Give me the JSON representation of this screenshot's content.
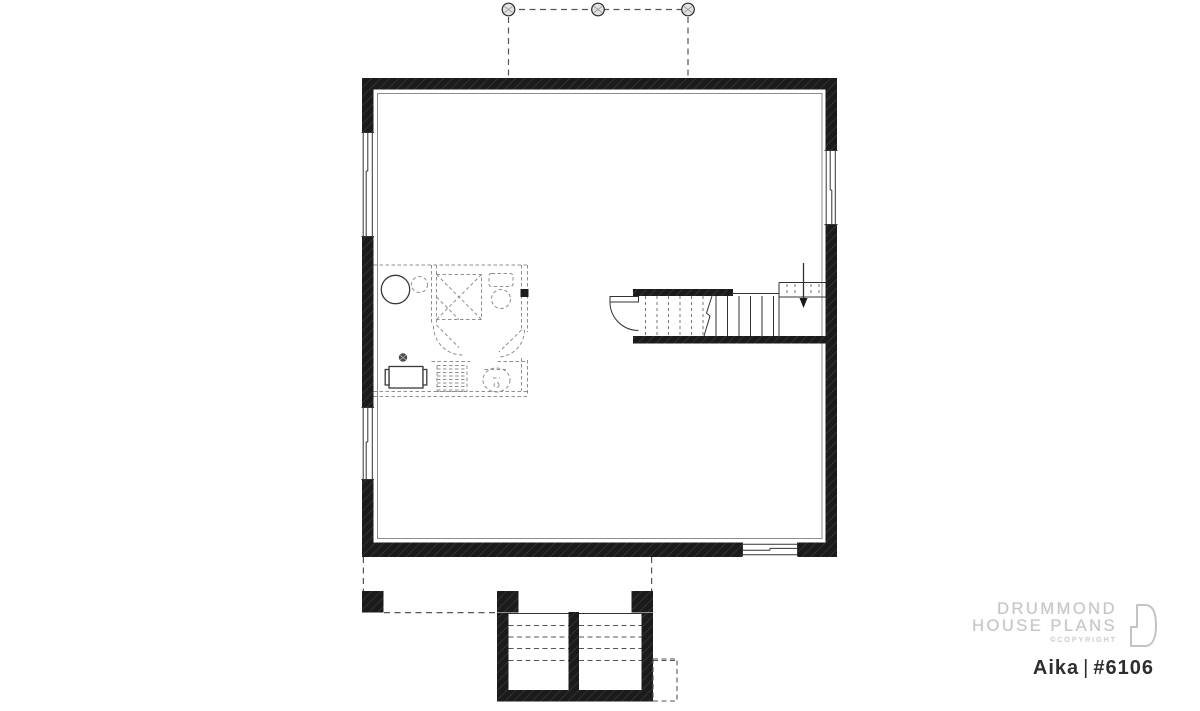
{
  "branding": {
    "line1": "DRUMMOND",
    "line2": "HOUSE PLANS",
    "copyright": "©COPYRIGHT"
  },
  "plan": {
    "name": "Aika",
    "separator": "|",
    "number": "#6106",
    "view": "basement floor plan"
  },
  "colors": {
    "background": "#ffffff",
    "wall": "#1b1b1b",
    "line": "#333333",
    "dash": "#555555",
    "light_dash": "#8f8f8f",
    "logo_gray": "#c6c6c6",
    "title_color": "#2e2e2e"
  }
}
